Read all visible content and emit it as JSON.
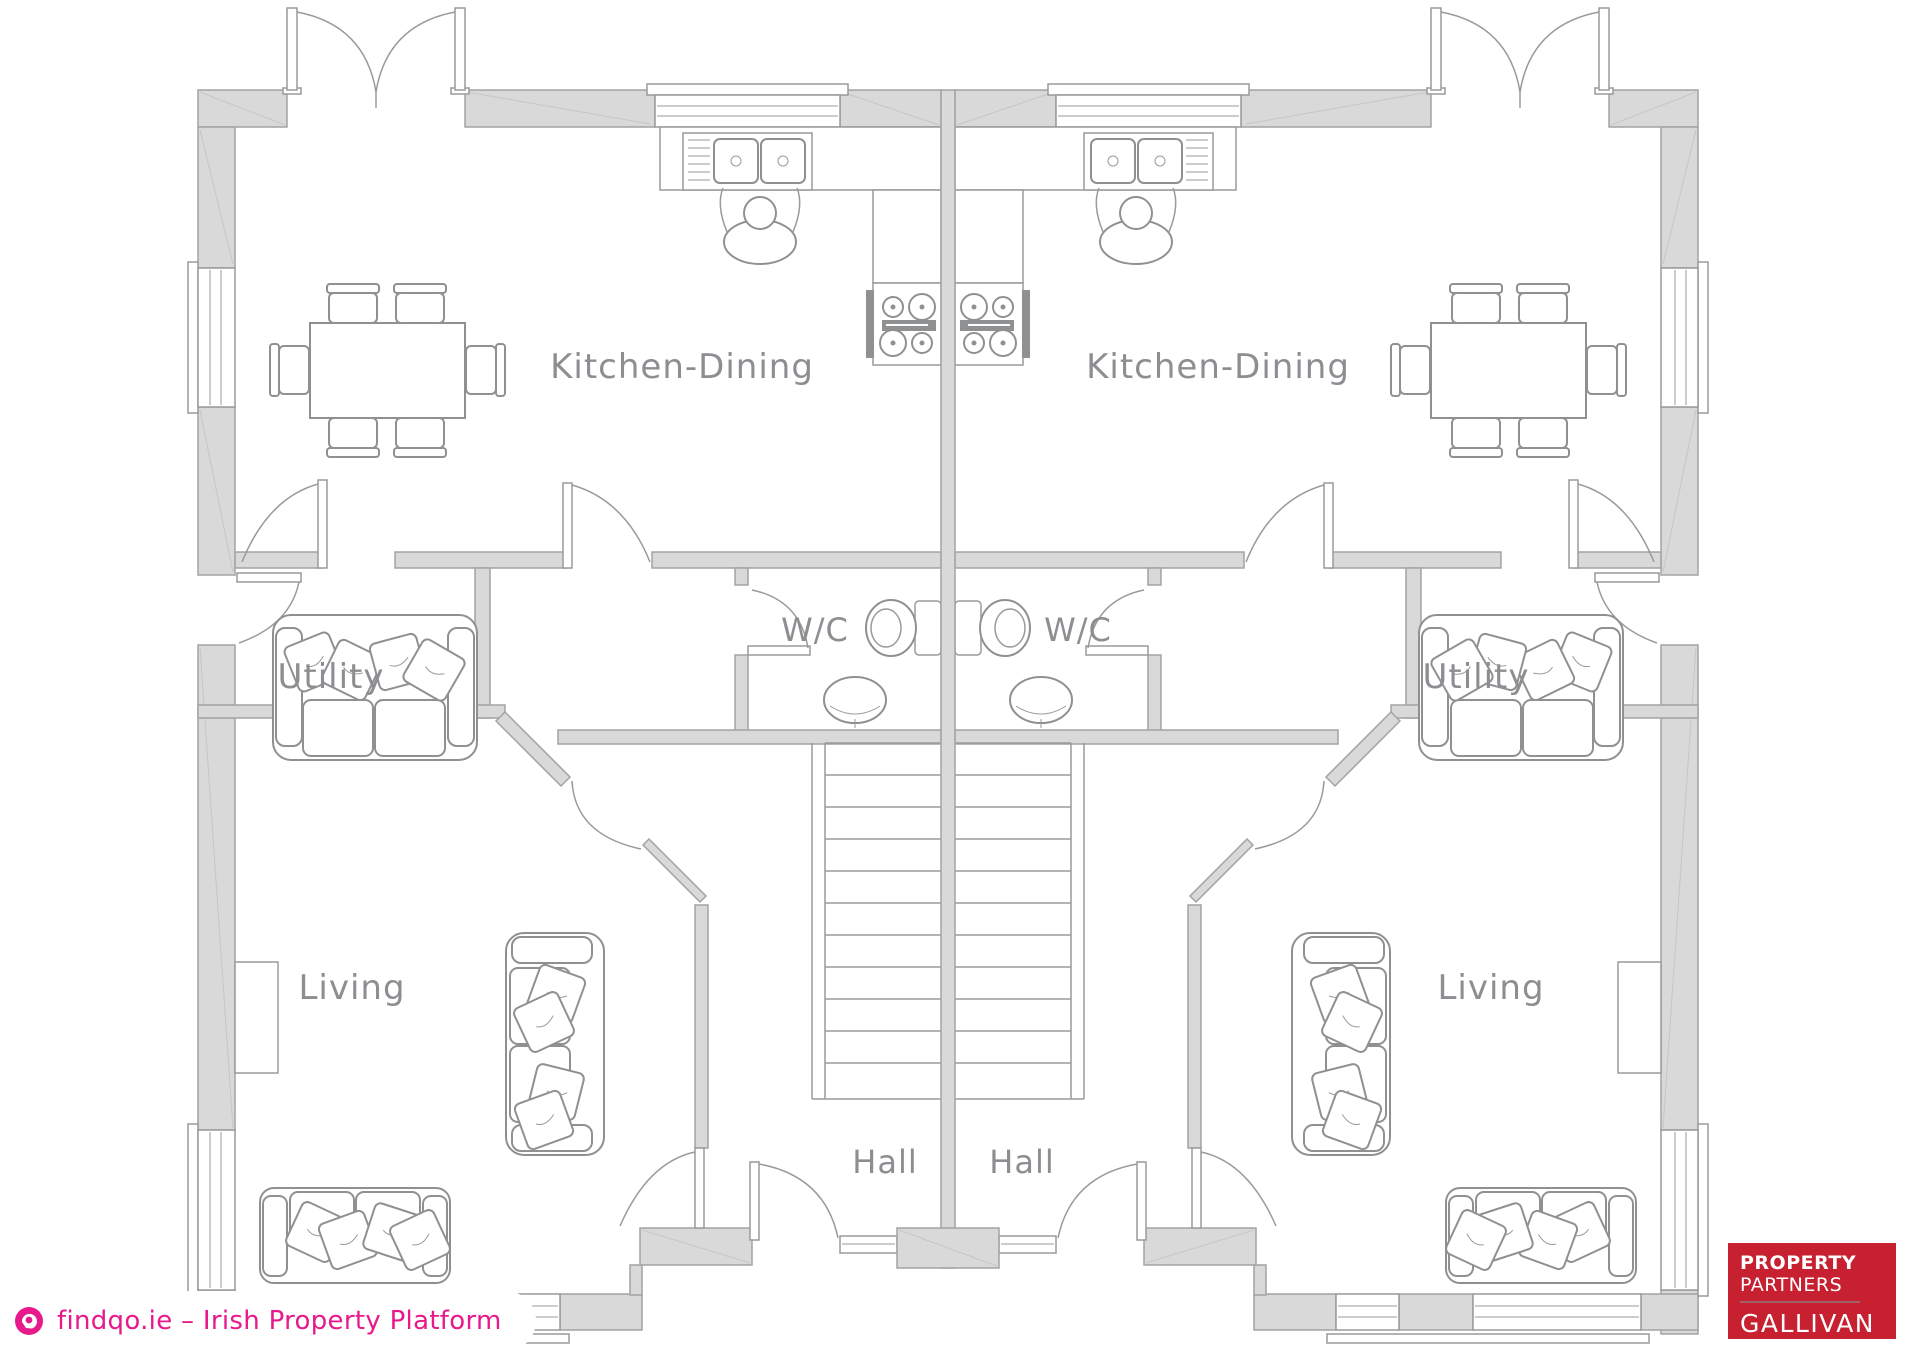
{
  "rooms": {
    "kitchen_dining_left": "Kitchen-Dining",
    "kitchen_dining_right": "Kitchen-Dining",
    "utility_left": "Utility",
    "utility_right": "Utility",
    "wc_left": "W/C",
    "wc_right": "W/C",
    "living_left": "Living",
    "living_right": "Living",
    "hall_left": "Hall",
    "hall_right": "Hall"
  },
  "watermark": {
    "text": "findqo.ie – Irish Property Platform",
    "icon": "findqo-globe-icon",
    "accent_color": "#e7198b"
  },
  "agency_logo": {
    "line1": "PROPERTY",
    "line2": "PARTNERS",
    "name": "GALLIVAN",
    "background_color": "#c62031",
    "text_color": "#ffffff"
  },
  "plan_colors": {
    "wall_fill": "#d9d9d9",
    "wall_stroke": "#a3a3a3",
    "line": "#9a9a9a",
    "label_text": "#8c8e91"
  }
}
